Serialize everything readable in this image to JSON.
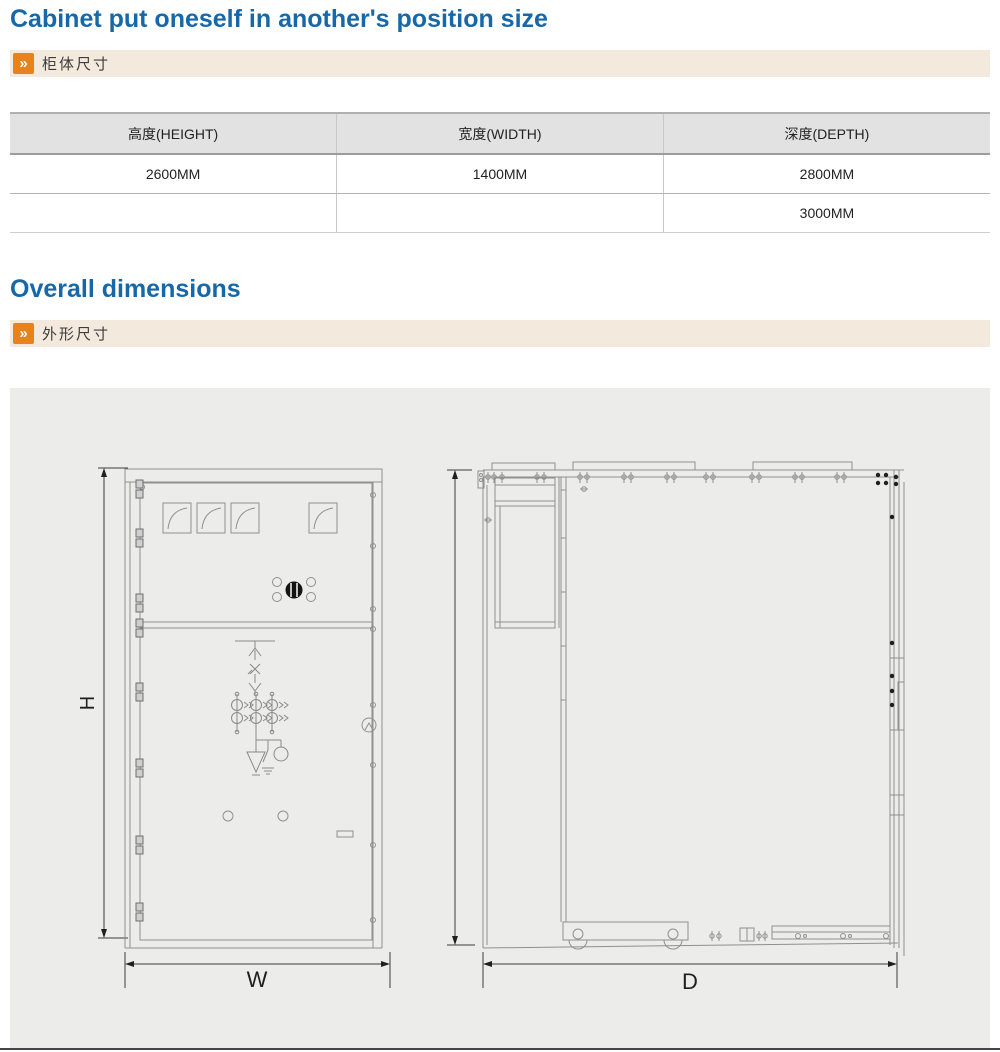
{
  "sections": {
    "cabinet": {
      "title": "Cabinet put oneself in another's position size",
      "band_label": "柜体尺寸",
      "chevron": "»"
    },
    "overall": {
      "title": "Overall dimensions",
      "band_label": "外形尺寸",
      "chevron": "»"
    }
  },
  "table": {
    "headers": [
      "高度(HEIGHT)",
      "宽度(WIDTH)",
      "深度(DEPTH)"
    ],
    "rows": [
      [
        "2600MM",
        "1400MM",
        "2800MM"
      ],
      [
        "",
        "",
        "3000MM"
      ]
    ]
  },
  "drawing": {
    "labels": {
      "height": "H",
      "width": "W",
      "depth": "D"
    }
  },
  "colors": {
    "title_blue": "#1668a8",
    "accent_orange": "#e8831c",
    "band_beige": "#f4e9dd",
    "table_header_bg": "#e2e2e2",
    "panel_gray": "#ececea",
    "line_gray": "#909090"
  }
}
